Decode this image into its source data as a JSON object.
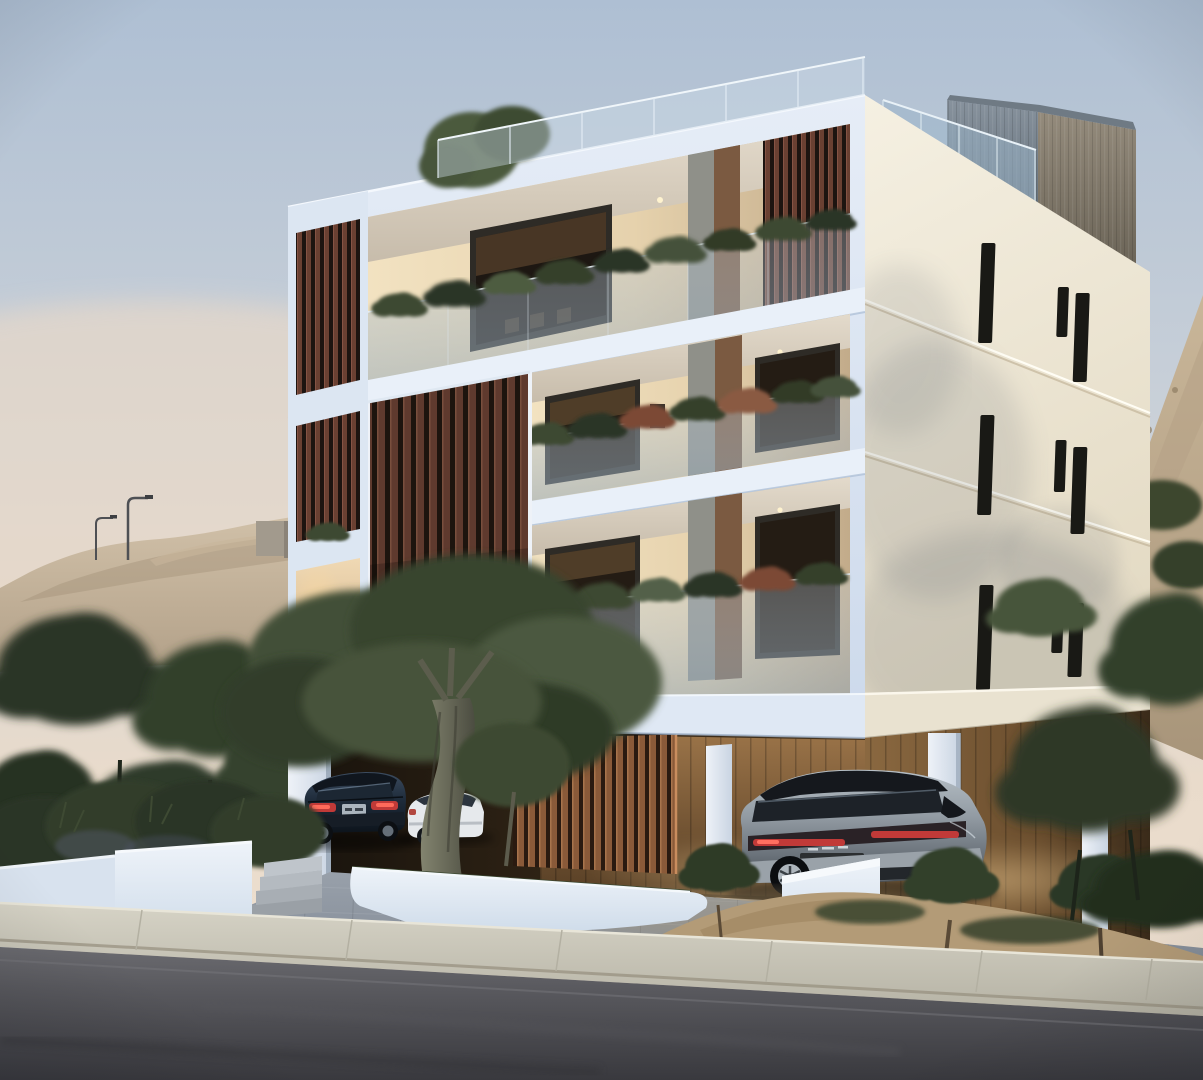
{
  "meta": {
    "type": "architectural-3d-render",
    "description": "Dusk exterior rendering of a modern three-storey white apartment building with wood slat screens, glass balustrade balconies with plants, rooftop glass railing terrace, covered ground-level parking with three cars, olive trees, white curved planters, concrete sidewalk and sloping asphalt road, sandy hills behind",
    "time_of_day": "dusk"
  },
  "scene": {
    "building": {
      "name": "modern-apartment-building",
      "floors_visible": 3,
      "roof": "terrace with frameless glass railing and grey stair core",
      "features": [
        "vertical wood slat screens",
        "recessed balconies with warm interior lighting",
        "glass balustrades with planting",
        "narrow vertical slit windows on side facade",
        "frosted glass stair box",
        "covered carport with wood slat feature wall"
      ]
    },
    "vehicles": [
      {
        "type": "sedan",
        "color": "dark blue-grey",
        "position": "left carport",
        "detail": "red tail lights, licence plate"
      },
      {
        "type": "sedan",
        "color": "white",
        "position": "left carport behind olive tree"
      },
      {
        "type": "suv",
        "color": "silver with black roof",
        "position": "right carport",
        "detail": "red tail light band"
      }
    ],
    "environment": {
      "setting": "hillside residential street at dusk",
      "foreground": [
        "asphalt road",
        "concrete sidewalk and curb",
        "white curved planter walls",
        "concrete steps",
        "olive trees",
        "sandy mound with young olive trees"
      ],
      "background": [
        "sandy excavated hills",
        "street lamps",
        "dark green trees",
        "concrete retaining wall"
      ]
    }
  },
  "colors": {
    "sky_top": "#aebfd3",
    "sky_mid": "#ccd2d9",
    "sky_horizon": "#e9dbcb",
    "sky_warm": "#efe1d1",
    "hill_sand_light": "#d0c0a8",
    "hill_sand_dark": "#b2a088",
    "tree_dark": "#2c3627",
    "front_facade_top": "#e6edf7",
    "front_facade_bottom": "#ccd9eb",
    "side_facade_top": "#f5f0e2",
    "side_facade_bottom": "#e4dbc5",
    "slit_window": "#191915",
    "slat_wood": "#6d4335",
    "slat_gap": "#221710",
    "interior_warm": "#f2e2c1",
    "interior_deep": "#c2ab8a",
    "glass_tint": "#94a8b8",
    "core_grey": "#87929d",
    "core_brown": "#948b7c",
    "carport_wood": "#9a7348",
    "planter_white": "#eef3f9",
    "paver_grey": "#8b939e",
    "sidewalk": "#d6d3c6",
    "asphalt_light": "#6b6b70",
    "asphalt_dark": "#39393e",
    "suv_silver": "#b6bfc6",
    "sedan_dark": "#1f2c3b",
    "taillight_red": "#c13a38",
    "lamp_metal": "#4e5054",
    "trunk_olive": "#83846f"
  }
}
